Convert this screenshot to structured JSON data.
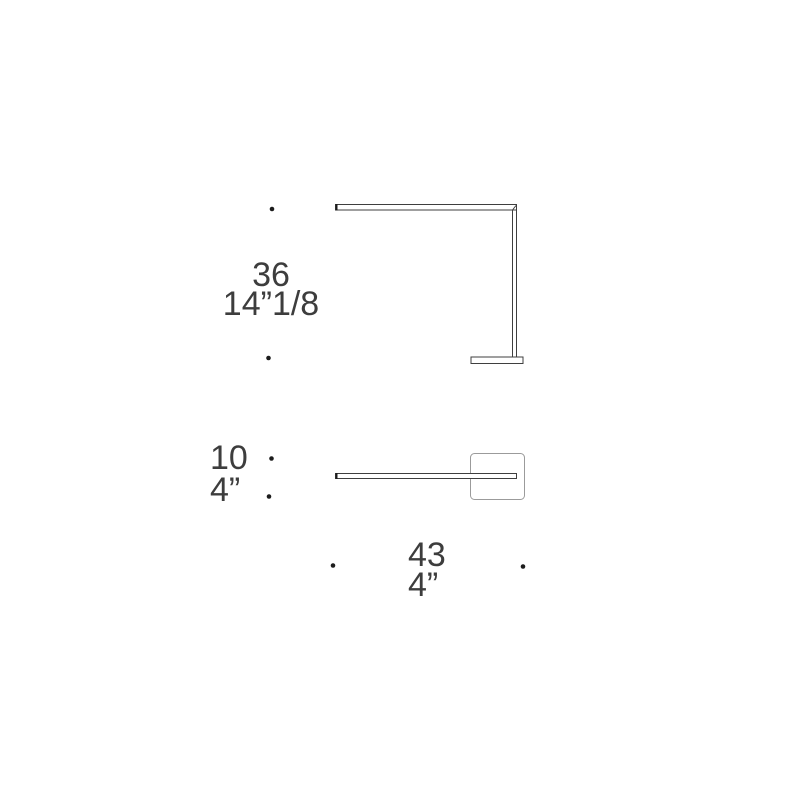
{
  "colors": {
    "background": "#ffffff",
    "line_dark": "#3f3f3f",
    "line_light": "#9b9b9b",
    "dot": "#1c1c1c",
    "text": "#3d3d3d"
  },
  "diagram": {
    "labels": {
      "height": {
        "cm": "36",
        "in": "14”1/8"
      },
      "depth": {
        "cm": "10",
        "in": "4”"
      },
      "width": {
        "cm": "43",
        "in": "4”"
      }
    }
  }
}
